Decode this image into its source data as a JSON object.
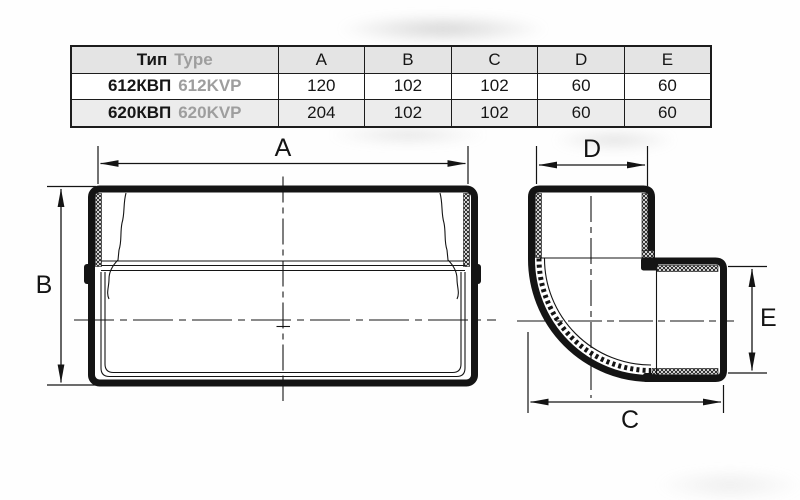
{
  "table": {
    "header": {
      "type_ru": "Тип",
      "type_en": "Type",
      "dims": [
        "A",
        "B",
        "C",
        "D",
        "E"
      ]
    },
    "rows": [
      {
        "name_ru": "612КВП",
        "name_en": "612KVP",
        "values": [
          "120",
          "102",
          "102",
          "60",
          "60"
        ]
      },
      {
        "name_ru": "620КВП",
        "name_en": "620KVP",
        "values": [
          "204",
          "102",
          "102",
          "60",
          "60"
        ]
      }
    ]
  },
  "drawings": {
    "straight": {
      "width_label": "A",
      "height_label": "B"
    },
    "elbow": {
      "top_label": "D",
      "right_label": "E",
      "bottom_label": "C"
    }
  },
  "colors": {
    "line": "#141414",
    "muted_text": "#9e9e9e",
    "header_bg": "#e4e4e4",
    "alt_row_bg": "#ececec"
  }
}
